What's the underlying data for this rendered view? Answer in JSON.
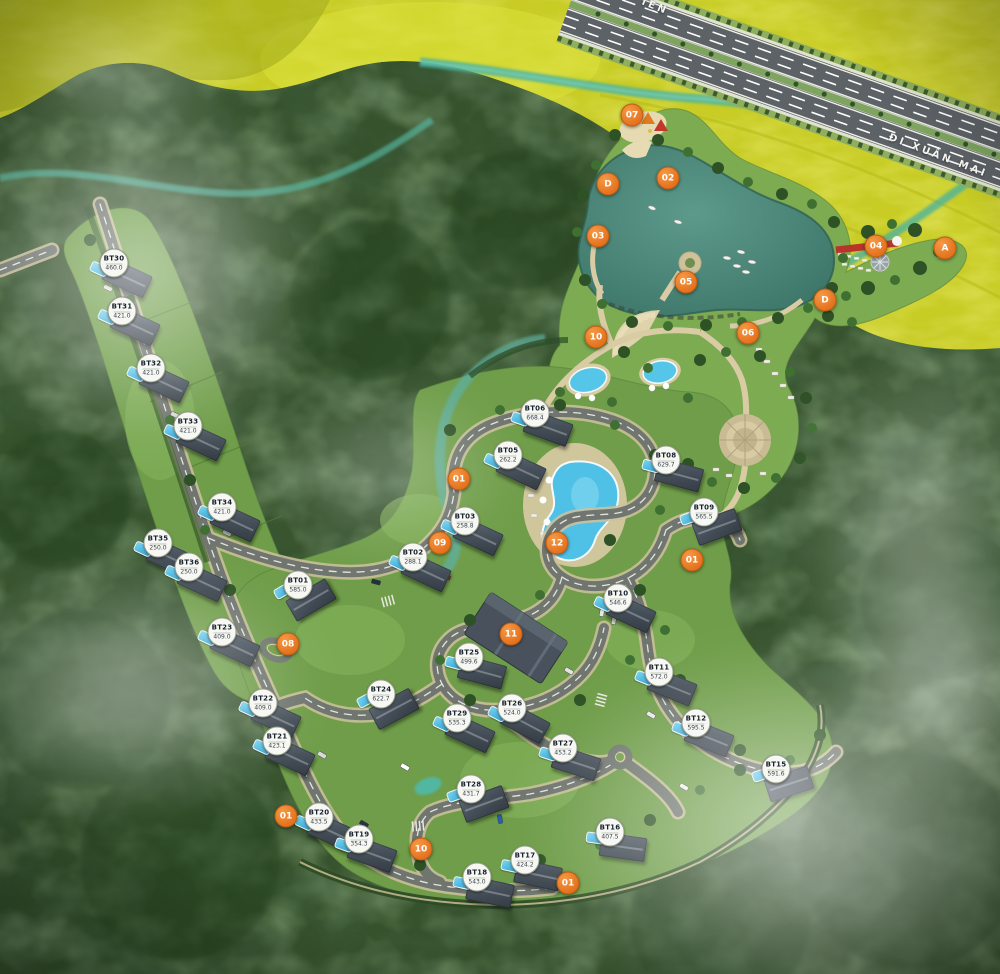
{
  "map": {
    "road_labels": [
      {
        "text": "ĐI XUÂN MAI",
        "x": 938,
        "y": 156,
        "angle": 21
      },
      {
        "text": "IÊN",
        "x": 655,
        "y": 7,
        "angle": 22
      }
    ],
    "villas": [
      {
        "id": "BT30",
        "area": "460.0",
        "x": 114,
        "y": 263,
        "rot": 25
      },
      {
        "id": "BT31",
        "area": "421.0",
        "x": 122,
        "y": 311,
        "rot": 25
      },
      {
        "id": "BT32",
        "area": "421.0",
        "x": 151,
        "y": 368,
        "rot": 25
      },
      {
        "id": "BT33",
        "area": "421.0",
        "x": 188,
        "y": 426,
        "rot": 25
      },
      {
        "id": "BT34",
        "area": "421.0",
        "x": 222,
        "y": 507,
        "rot": 25
      },
      {
        "id": "BT35",
        "area": "250.0",
        "x": 158,
        "y": 543,
        "rot": 25
      },
      {
        "id": "BT36",
        "area": "250.0",
        "x": 189,
        "y": 567,
        "rot": 25
      },
      {
        "id": "BT01",
        "area": "585.0",
        "x": 298,
        "y": 585,
        "rot": -30
      },
      {
        "id": "BT23",
        "area": "409.0",
        "x": 222,
        "y": 632,
        "rot": 25
      },
      {
        "id": "BT22",
        "area": "409.0",
        "x": 263,
        "y": 703,
        "rot": 25
      },
      {
        "id": "BT21",
        "area": "423.1",
        "x": 277,
        "y": 741,
        "rot": 25
      },
      {
        "id": "BT20",
        "area": "433.5",
        "x": 319,
        "y": 817,
        "rot": 25
      },
      {
        "id": "BT19",
        "area": "354.3",
        "x": 359,
        "y": 839,
        "rot": 20
      },
      {
        "id": "BT18",
        "area": "543.0",
        "x": 477,
        "y": 877,
        "rot": 12
      },
      {
        "id": "BT17",
        "area": "424.2",
        "x": 525,
        "y": 860,
        "rot": 12
      },
      {
        "id": "BT16",
        "area": "407.5",
        "x": 610,
        "y": 832,
        "rot": 8
      },
      {
        "id": "BT15",
        "area": "591.6",
        "x": 776,
        "y": 769,
        "rot": -18
      },
      {
        "id": "BT12",
        "area": "595.5",
        "x": 696,
        "y": 723,
        "rot": 22
      },
      {
        "id": "BT11",
        "area": "572.0",
        "x": 659,
        "y": 672,
        "rot": 22
      },
      {
        "id": "BT10",
        "area": "546.6",
        "x": 618,
        "y": 598,
        "rot": 25
      },
      {
        "id": "BT09",
        "area": "565.5",
        "x": 704,
        "y": 512,
        "rot": -20
      },
      {
        "id": "BT08",
        "area": "629.7",
        "x": 666,
        "y": 460,
        "rot": 15
      },
      {
        "id": "BT06",
        "area": "668.4",
        "x": 535,
        "y": 413,
        "rot": 20
      },
      {
        "id": "BT05",
        "area": "262.2",
        "x": 508,
        "y": 455,
        "rot": 25
      },
      {
        "id": "BT03",
        "area": "258.8",
        "x": 465,
        "y": 521,
        "rot": 25
      },
      {
        "id": "BT02",
        "area": "288.1",
        "x": 413,
        "y": 557,
        "rot": 25
      },
      {
        "id": "BT24",
        "area": "622.7",
        "x": 381,
        "y": 694,
        "rot": -28
      },
      {
        "id": "BT25",
        "area": "499.6",
        "x": 469,
        "y": 657,
        "rot": 15
      },
      {
        "id": "BT26",
        "area": "524.0",
        "x": 512,
        "y": 708,
        "rot": 28
      },
      {
        "id": "BT27",
        "area": "453.2",
        "x": 563,
        "y": 748,
        "rot": 18
      },
      {
        "id": "BT28",
        "area": "431.7",
        "x": 471,
        "y": 789,
        "rot": -20
      },
      {
        "id": "BT29",
        "area": "535.3",
        "x": 457,
        "y": 718,
        "rot": 25
      }
    ],
    "markers": [
      {
        "label": "07",
        "x": 632,
        "y": 115
      },
      {
        "label": "02",
        "x": 668,
        "y": 178
      },
      {
        "label": "D",
        "x": 608,
        "y": 184
      },
      {
        "label": "03",
        "x": 598,
        "y": 236
      },
      {
        "label": "05",
        "x": 686,
        "y": 282
      },
      {
        "label": "04",
        "x": 876,
        "y": 246
      },
      {
        "label": "A",
        "x": 945,
        "y": 248
      },
      {
        "label": "D",
        "x": 825,
        "y": 300
      },
      {
        "label": "10",
        "x": 596,
        "y": 337
      },
      {
        "label": "06",
        "x": 748,
        "y": 333
      },
      {
        "label": "01",
        "x": 459,
        "y": 479
      },
      {
        "label": "09",
        "x": 440,
        "y": 543
      },
      {
        "label": "12",
        "x": 557,
        "y": 543
      },
      {
        "label": "08",
        "x": 288,
        "y": 644
      },
      {
        "label": "11",
        "x": 511,
        "y": 634
      },
      {
        "label": "01",
        "x": 692,
        "y": 560
      },
      {
        "label": "01",
        "x": 286,
        "y": 816
      },
      {
        "label": "10",
        "x": 421,
        "y": 849
      },
      {
        "label": "01",
        "x": 568,
        "y": 883
      }
    ]
  }
}
